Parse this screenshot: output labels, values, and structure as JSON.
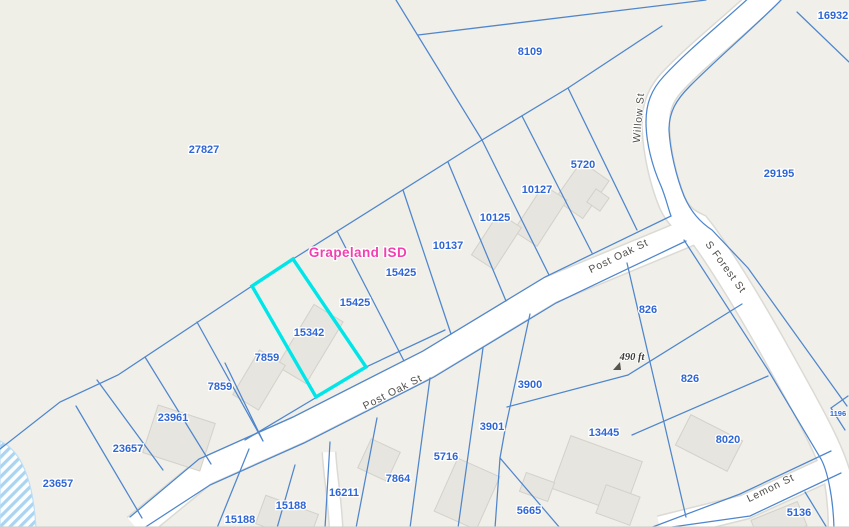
{
  "map": {
    "district_label": "Grapeland ISD",
    "measurement_label": "490 ft",
    "selected_parcel": "15342",
    "selection_color": "#00e6e8",
    "colors": {
      "background": "#f0efe9",
      "parcel_line": "#4f86cc",
      "parcel_label": "#2f66d5",
      "district_label": "#f33fb0",
      "street_fill": "#ffffff",
      "street_casing": "#dbdad5",
      "street_label": "#4f4e4a",
      "building_fill": "#e7e5df",
      "water_hatch": "#abd4f1"
    },
    "streets": [
      {
        "name": "Willow St"
      },
      {
        "name": "S Forest St"
      },
      {
        "name": "Post Oak St"
      },
      {
        "name": "Post Oak St"
      },
      {
        "name": "Lemon St"
      }
    ],
    "parcels": [
      {
        "id": "16932",
        "x": 833,
        "y": 19
      },
      {
        "id": "8109",
        "x": 530,
        "y": 55
      },
      {
        "id": "27827",
        "x": 204,
        "y": 153
      },
      {
        "id": "29195",
        "x": 779,
        "y": 177
      },
      {
        "id": "5720",
        "x": 583,
        "y": 168
      },
      {
        "id": "10127",
        "x": 537,
        "y": 193
      },
      {
        "id": "10125",
        "x": 495,
        "y": 221
      },
      {
        "id": "10137",
        "x": 448,
        "y": 249
      },
      {
        "id": "15425",
        "x": 401,
        "y": 276
      },
      {
        "id": "15425",
        "x": 355,
        "y": 306
      },
      {
        "id": "15342",
        "x": 309,
        "y": 336
      },
      {
        "id": "7859",
        "x": 267,
        "y": 361
      },
      {
        "id": "7859",
        "x": 220,
        "y": 390
      },
      {
        "id": "23961",
        "x": 173,
        "y": 421
      },
      {
        "id": "23657",
        "x": 128,
        "y": 452
      },
      {
        "id": "23657",
        "x": 58,
        "y": 487
      },
      {
        "id": "15188",
        "x": 240,
        "y": 523
      },
      {
        "id": "15188",
        "x": 291,
        "y": 509
      },
      {
        "id": "16211",
        "x": 344,
        "y": 496
      },
      {
        "id": "7864",
        "x": 398,
        "y": 482
      },
      {
        "id": "5716",
        "x": 446,
        "y": 460
      },
      {
        "id": "3901",
        "x": 492,
        "y": 430
      },
      {
        "id": "3900",
        "x": 530,
        "y": 388
      },
      {
        "id": "13445",
        "x": 604,
        "y": 436
      },
      {
        "id": "5665",
        "x": 529,
        "y": 514
      },
      {
        "id": "826",
        "x": 648,
        "y": 313
      },
      {
        "id": "826",
        "x": 690,
        "y": 382
      },
      {
        "id": "8020",
        "x": 728,
        "y": 443
      },
      {
        "id": "5136",
        "x": 799,
        "y": 516
      },
      {
        "id": "1196",
        "x": 838,
        "y": 416,
        "small": true
      }
    ]
  }
}
